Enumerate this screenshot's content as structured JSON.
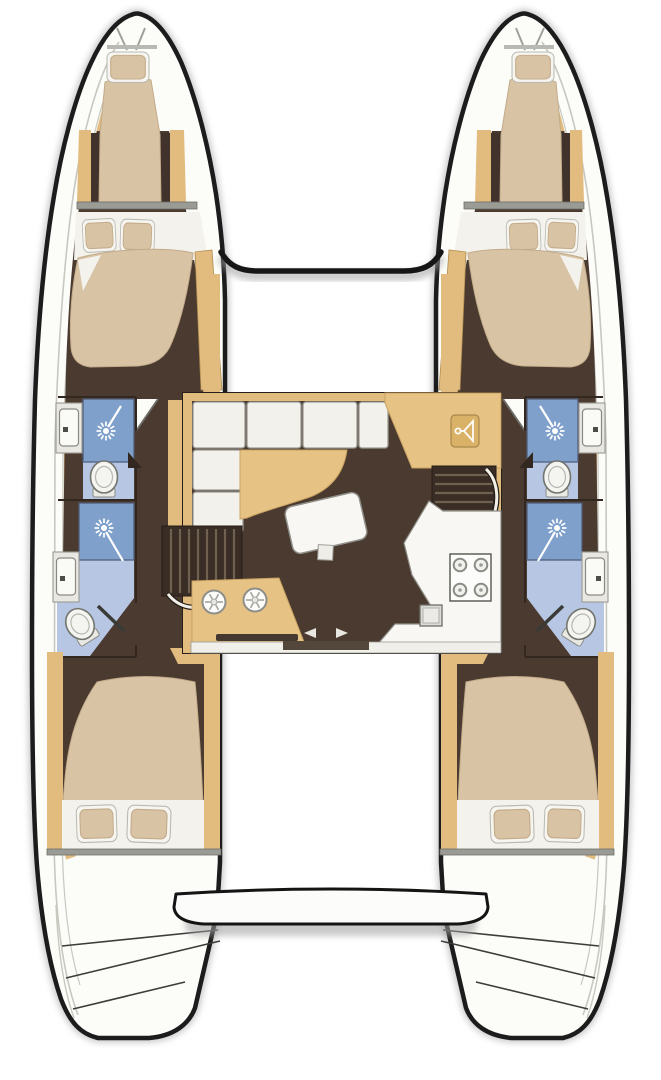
{
  "diagram": {
    "type": "boat-floor-plan",
    "view": "top-down",
    "vessel": "twin-hull sailing catamaran",
    "text_labels": [],
    "areas": {
      "bow": {
        "port": [
          "forepeak-berth-with-pillow"
        ],
        "starboard": [
          "forepeak-berth-with-pillow"
        ],
        "center": [
          "forward-crossbeam",
          "foredeck"
        ]
      },
      "port_hull": {
        "forward_cabin": [
          "double-berth",
          "two-pillows",
          "inboard-wardrobe-shelf"
        ],
        "forward_head": [
          "shower-cubicle",
          "shower-head",
          "toilet",
          "sink-vanity",
          "door"
        ],
        "aft_head": [
          "shower-cubicle",
          "shower-head",
          "toilet",
          "sink-vanity",
          "door"
        ],
        "aft_cabin": [
          "double-berth",
          "two-pillows"
        ],
        "stern": [
          "transom-swim-steps"
        ]
      },
      "starboard_hull": {
        "forward_cabin": [
          "double-berth",
          "two-pillows",
          "inboard-wardrobe-shelf"
        ],
        "forward_head": [
          "shower-cubicle",
          "shower-head",
          "toilet",
          "sink-vanity",
          "door"
        ],
        "aft_head": [
          "shower-cubicle",
          "shower-head",
          "toilet",
          "sink-vanity",
          "door"
        ],
        "aft_cabin": [
          "double-berth",
          "two-pillows"
        ],
        "stern": [
          "transom-swim-steps"
        ]
      },
      "salon": {
        "forward": [
          "l-shaped-white-settee",
          "curved-chaise-bench"
        ],
        "center": [
          "dining-table",
          "table-leg-block"
        ],
        "starboard_forward": [
          "wardrobe-locker-with-hanger"
        ],
        "companionways": [
          "port-stairs-to-hull",
          "starboard-stairs-to-hull"
        ],
        "galley_port": [
          "twin-round-sinks",
          "towel-bar"
        ],
        "galley_starboard": [
          "four-burner-stove",
          "small-sink",
          "angled-counter"
        ],
        "aft": [
          "sliding-door-with-arrows",
          "threshold-strip"
        ]
      },
      "aft": [
        "open-cockpit",
        "aft-crossbeam-bench",
        "space-between-transoms"
      ]
    },
    "fixture_counts": {
      "cabins": 4,
      "berths_total": 6,
      "heads": 4,
      "showers": 4,
      "toilets": 4,
      "bathroom_sinks": 4,
      "stove_burners": 4,
      "galley_round_sinks": 2
    },
    "icons": [
      "shower-head-icon",
      "toilet-icon",
      "sink-icon",
      "hanger-icon",
      "stove-burner-icon",
      "sliding-door-arrows-icon"
    ]
  },
  "colors": {
    "outline": "#1c1c1c",
    "shadow": "#a6a6a6",
    "deck": "#fcfcf9",
    "deck_line": "#c8c8c1",
    "trim_tan": "#e2bb7e",
    "trim_tan_dark": "#c59e61",
    "cabin_floor": "#4b3a30",
    "stair_floor": "#3a2d25",
    "step_line": "#70604f",
    "mattress": "#d8c3a4",
    "mattress_edge": "#c2ab8a",
    "linen": "#f4f2ec",
    "cushion": "#f3f1ec",
    "cushion_edge": "#9b9b95",
    "seat_tan": "#e6c385",
    "shower_blue": "#7fa0cb",
    "bath_floor": "#b7c7e3",
    "fixture_white": "#f4f4f0",
    "fixture_edge": "#74746e",
    "counter_white": "#f8f7f3",
    "wall_gray": "#9b9b95",
    "track_dark": "#53463b",
    "burner_gray": "#8c8c86"
  }
}
